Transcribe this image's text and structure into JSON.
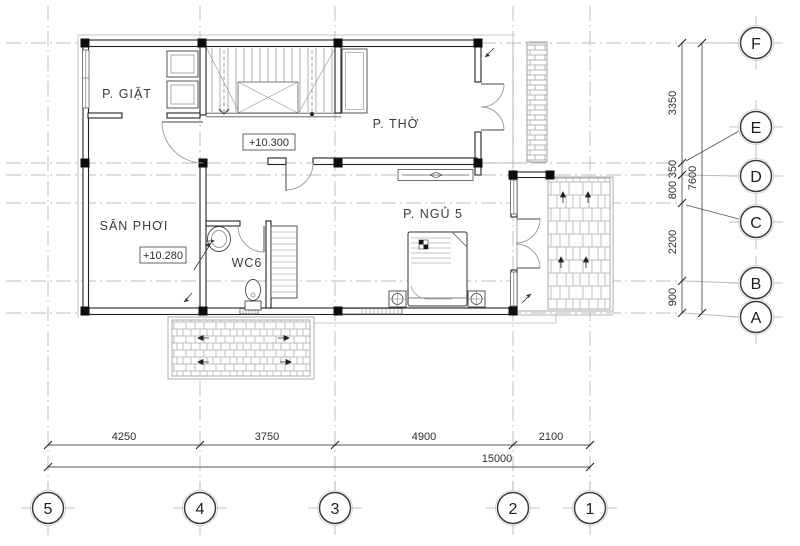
{
  "rooms": [
    {
      "id": "laundry",
      "label": "P. GIẶT"
    },
    {
      "id": "worship",
      "label": "P. THỜ"
    },
    {
      "id": "drying-yard",
      "label": "SÂN PHƠI"
    },
    {
      "id": "wc",
      "label": "WC6"
    },
    {
      "id": "bedroom5",
      "label": "P. NGỦ 5"
    }
  ],
  "levels": [
    {
      "id": "hall-level",
      "label": "+10.300"
    },
    {
      "id": "yard-level",
      "label": "+10.280"
    }
  ],
  "grid": {
    "rows": [
      "F",
      "E",
      "D",
      "C",
      "B",
      "A"
    ],
    "cols": [
      "5",
      "4",
      "3",
      "2",
      "1"
    ]
  },
  "dims": {
    "right": [
      "3350",
      "350",
      "800",
      "2200",
      "900"
    ],
    "right_total": "7600",
    "bottom": [
      "4250",
      "3750",
      "4900",
      "2100"
    ],
    "bottom_total": "15000"
  },
  "colors": {
    "wall": "#1d1d1d",
    "grid_line": "#b9b9b9",
    "hatch": "#9a9a9a",
    "dim_line": "#555555"
  }
}
